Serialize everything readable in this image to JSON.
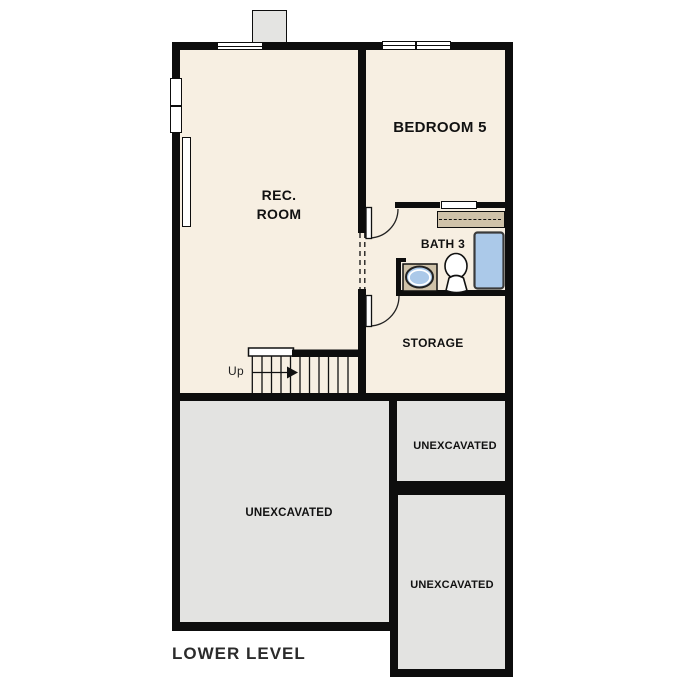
{
  "plan_title": "LOWER LEVEL",
  "rooms": {
    "rec_room": {
      "label_line1": "REC.",
      "label_line2": "ROOM"
    },
    "bedroom5": {
      "label": "BEDROOM 5"
    },
    "bath3": {
      "label": "BATH 3"
    },
    "storage": {
      "label": "STORAGE"
    },
    "unexcavated_left": {
      "label": "UNEXCAVATED"
    },
    "unexcavated_top_right": {
      "label": "UNEXCAVATED"
    },
    "unexcavated_bottom_right": {
      "label": "UNEXCAVATED"
    }
  },
  "stairs": {
    "direction_label": "Up"
  },
  "fixtures": [
    "bathtub",
    "toilet",
    "sink-vanity",
    "closet-shelf",
    "chimney"
  ],
  "colors": {
    "wall": "#0d0d0d",
    "floor_cream": "#f7efe2",
    "unexcavated_gray": "#e3e3e1",
    "fixture_blue": "#abc9e9",
    "casework_tan": "#cfc2a9",
    "title_text": "#2b2b2b"
  }
}
